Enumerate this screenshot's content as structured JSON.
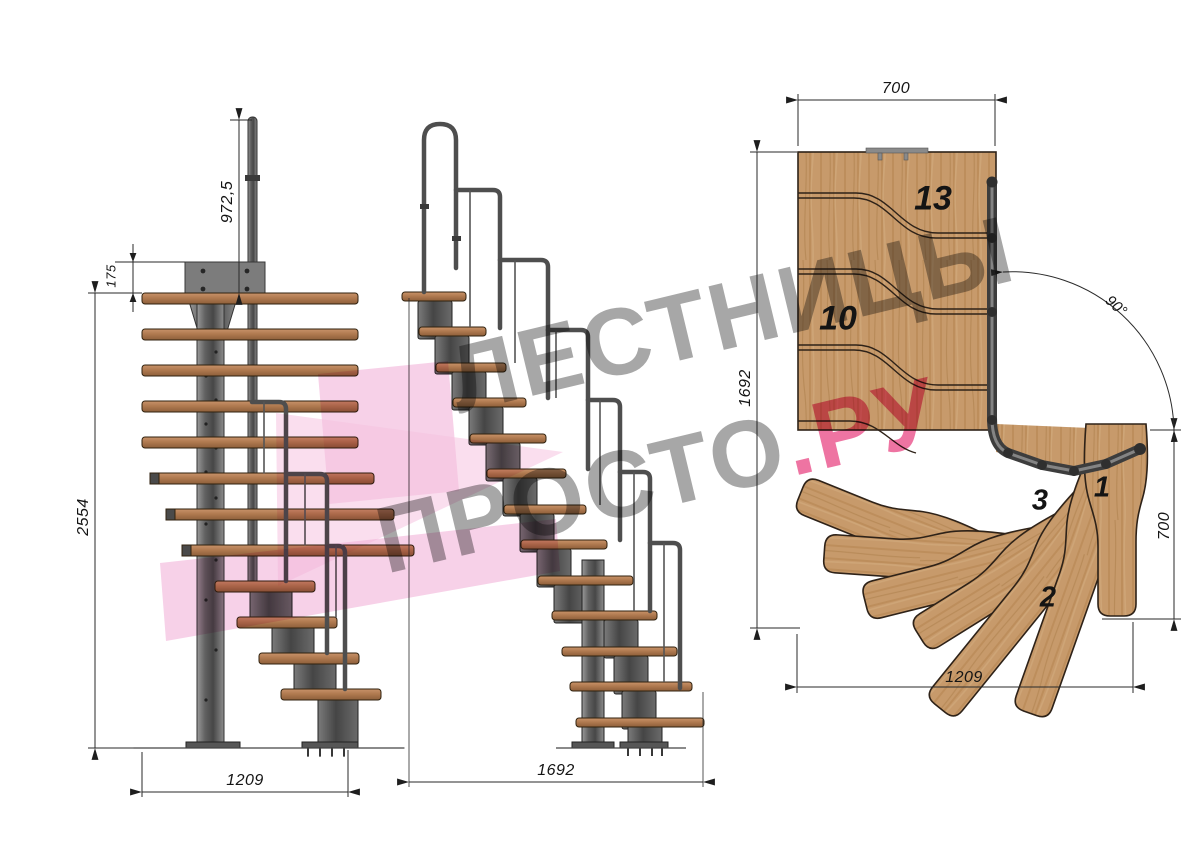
{
  "watermark": {
    "line1": "ЛЕСТНИЦЫ",
    "line2_gray": "ПРОСТО",
    "line2_pink": ".РУ"
  },
  "left_view": {
    "dim_handrail_height": "972,5",
    "dim_top_offset": "175",
    "dim_total_height": "2554",
    "dim_width": "1209"
  },
  "front_view": {
    "dim_length": "1692"
  },
  "plan_view": {
    "dim_top_width": "700",
    "dim_side_length": "1692",
    "dim_turn_angle": "90°",
    "dim_entry_width": "700",
    "dim_bottom_length": "1209",
    "steps": {
      "n13": "13",
      "n10": "10",
      "n3": "3",
      "n1": "1",
      "n2": "2"
    }
  },
  "colors": {
    "accent_pink": "#e21864",
    "watermark_gray": "#9a9a9a",
    "wood_plan": "#c79a6b",
    "wood_tread": "#b07a50",
    "steel": "#5a5a5a",
    "line": "#2b2b2b"
  }
}
